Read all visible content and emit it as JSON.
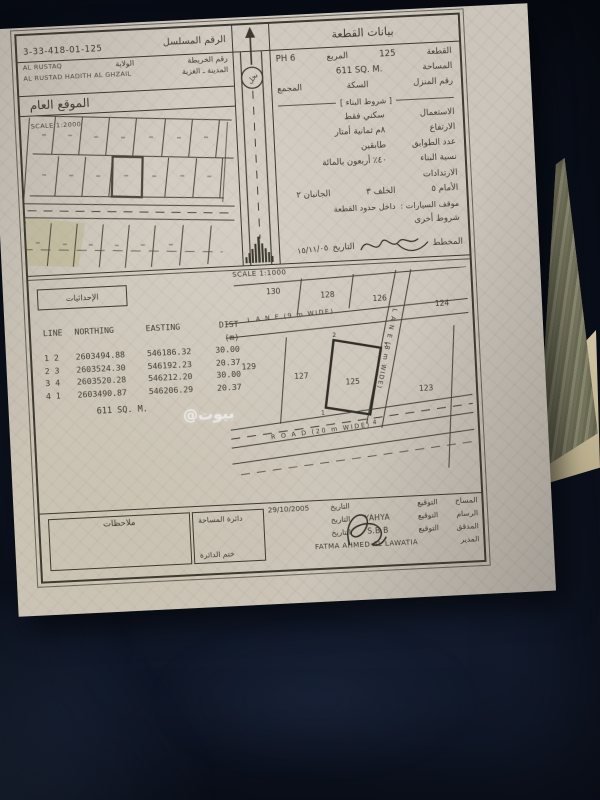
{
  "photo": {
    "watermark": "@بيوت"
  },
  "colors": {
    "paper": "#ccc5bb",
    "fabric": "#0d1424",
    "ink": "#3c392f",
    "green_sheet": "#7c7b62",
    "beige_sheet": "#cfc2a0"
  },
  "header": {
    "serial_label": "الرقم المسلسل",
    "serial_value": "3-33-418-01-125",
    "plot_data_title": "بيانات القطعة"
  },
  "location_map": {
    "map_no_label": "رقم الخريطة",
    "wilaya_label": "الولاية",
    "wilaya_en": "AL RUSTAQ",
    "town_label": "المدينة ـ الغزية",
    "town_en": "AL RUSTAD HADITH AL GHZAIL",
    "title": "الموقع العام",
    "scale": "SCALE 1:2000",
    "road_circle": "نخل"
  },
  "plot_info": {
    "plot_label": "القطعة",
    "plot_value": "125",
    "square_label": "المربع",
    "square_value": "PH 6",
    "area_label": "المساحة",
    "area_value": "611 SQ. M.",
    "house_no_label": "رقم المنزل",
    "street_label": "السكة",
    "complex_label": "المجمع",
    "conditions_title": "[ شروط البناء ]",
    "use_label": "الاستعمال",
    "use_value": "سكني فقط",
    "height_label": "الارتفاع",
    "height_value": "٨م ثمانية أمتار",
    "floors_label": "عدد الطوابق",
    "floors_value": "طابقين",
    "ratio_label": "نسبة البناء",
    "ratio_value": "٤٠٪ أربعون بالمائة",
    "setbacks_label": "الارتدادات",
    "setback_front": "الأمام ٥",
    "setback_back": "الخلف ٣",
    "setback_sides": "الجانبان ٢",
    "parking_label": "موقف السيارات :",
    "parking_value": "داخل حدود القطعة",
    "other_terms_label": "شروط أخرى",
    "planner_label": "المخطط",
    "planner_date_label": "التاريخ",
    "planner_date": "١٥/١١/٠٥"
  },
  "survey_section": {
    "coords_label": "الإحداثيات",
    "scale": "SCALE 1:1000",
    "area_note": "611 SQ. M.",
    "table": {
      "headers": [
        "LINE",
        "NORTHING",
        "EASTING",
        "DIST (m)"
      ],
      "rows": [
        {
          "from": "1",
          "to": "2",
          "northing": "2603494.88",
          "easting": "546186.32",
          "dist": "30.00"
        },
        {
          "from": "2",
          "to": "3",
          "northing": "2603524.30",
          "easting": "546192.23",
          "dist": "20.37"
        },
        {
          "from": "3",
          "to": "4",
          "northing": "2603520.28",
          "easting": "546212.20",
          "dist": "30.00"
        },
        {
          "from": "4",
          "to": "1",
          "northing": "2603490.87",
          "easting": "546206.29",
          "dist": "20.37"
        }
      ]
    }
  },
  "site_plan": {
    "plots": {
      "p130": "130",
      "p128": "128",
      "p126": "126",
      "p124": "124",
      "p129": "129",
      "p127": "127",
      "p125": "125",
      "p123": "123"
    },
    "lane_h": "L A N E  (9 m WIDE)",
    "lane_v": "L A N E  (8 m WIDE)",
    "road": "R O A D  (20 m WIDE)",
    "corners": {
      "c1": "1",
      "c2": "2",
      "c3": "3",
      "c4": "4"
    }
  },
  "footer": {
    "notes_label": "ملاحظات",
    "dept_label": "دائرة المساحة",
    "stamp_label": "ختم الدائرة",
    "sign_label": "التوقيع",
    "date_label": "التاريخ",
    "rows": [
      {
        "role": "المساح",
        "sig": "",
        "date": "29/10/2005"
      },
      {
        "role": "الرسام",
        "sig": "YAHYA",
        "date": ""
      },
      {
        "role": "المدقق",
        "sig": "S.B.B",
        "date": ""
      },
      {
        "role": "المدير",
        "sig": "FATMA AHMED AL LAWATIA",
        "date": ""
      }
    ]
  }
}
